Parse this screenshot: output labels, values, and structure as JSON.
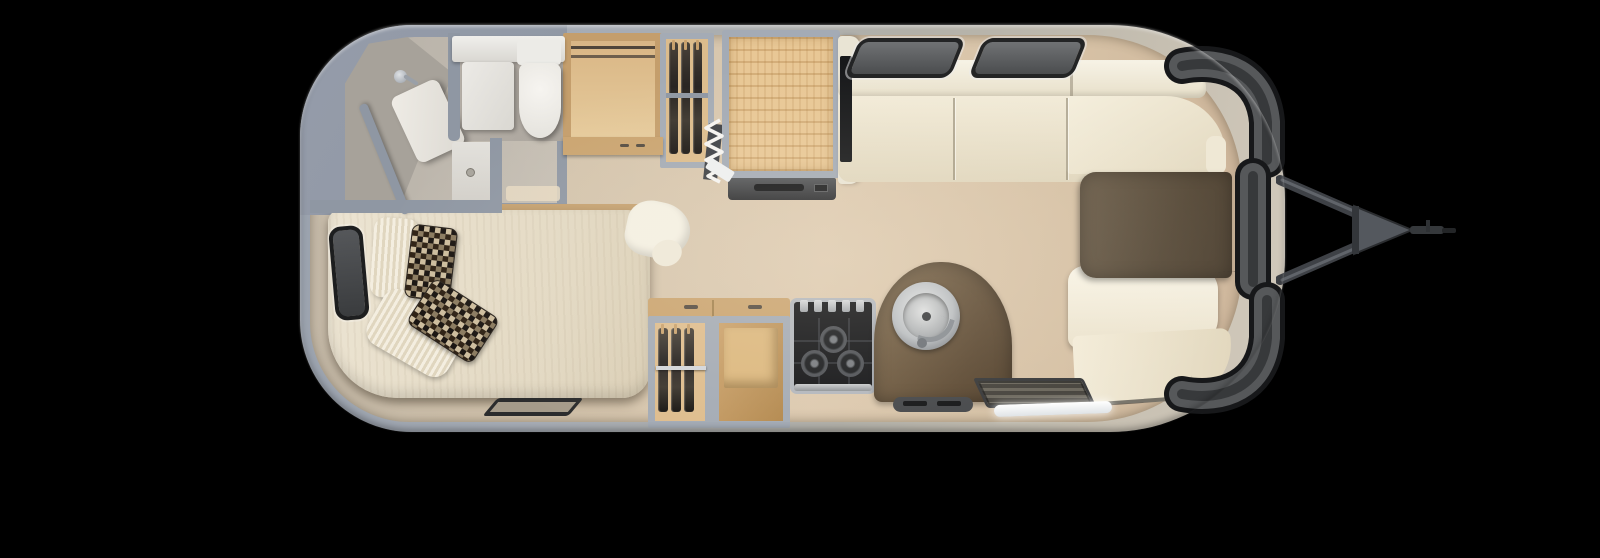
{
  "scene": {
    "type": "travel-trailer-floorplan",
    "view": "top-down 3D render",
    "background": "#000000",
    "orientation": "hitch-right"
  },
  "colors": {
    "bg": "#000000",
    "wall": "#8f97a3",
    "steel": "#a4abb5",
    "wood": "#c49e6c",
    "wood-light": "#e6cb9c",
    "wood-mid": "#caa470",
    "wicker": "#e8c795",
    "cream-dark": "#e0d6bd",
    "mattress-a": "#ece4d2",
    "mattress-b": "#d9cdb4",
    "table-a": "#6b5d4a",
    "table-b": "#4e4233",
    "counter-a": "#7b664a",
    "counter-b": "#53422e",
    "textile": "#2e2722",
    "appliance": "#141518",
    "vent-dark": "#45474a",
    "glass": "#56585a",
    "glass-dark": "#17181a",
    "hitch-metal": "#3e4146",
    "glow": "#ffffff"
  },
  "items": {
    "trailer": "Travel trailer body shell",
    "hitch": "A-frame tow hitch with coupler",
    "bathroom": "Rear bathroom",
    "shower": "Corner shower with angled partition",
    "vanity": "Bathroom vanity",
    "toilet": "Toilet",
    "wardrobe": "Wardrobe with drawers",
    "closet_top": "Closet with hanging clothes",
    "folding_door": "Folding partition door",
    "refrigerator": "Refrigerator with wicker front",
    "bed": "Bed with pillows and throw pillows",
    "side_window": "Side window",
    "roadside_window": "Roadside window",
    "nose_window": "Wrap-around front window",
    "dinette": "Front wrap-around dinette sofa",
    "table": "Dinette table",
    "bench": "Dinette bench seat",
    "closet_galley": "Galley closet with hanging clothes",
    "cabinet": "Open storage cabinet",
    "stove": "Three-burner cooktop",
    "sink": "Round galley sink with faucet",
    "entry_step": "Entry door step",
    "threshold": "Entry door threshold",
    "floor_vent": "Floor vent register"
  }
}
